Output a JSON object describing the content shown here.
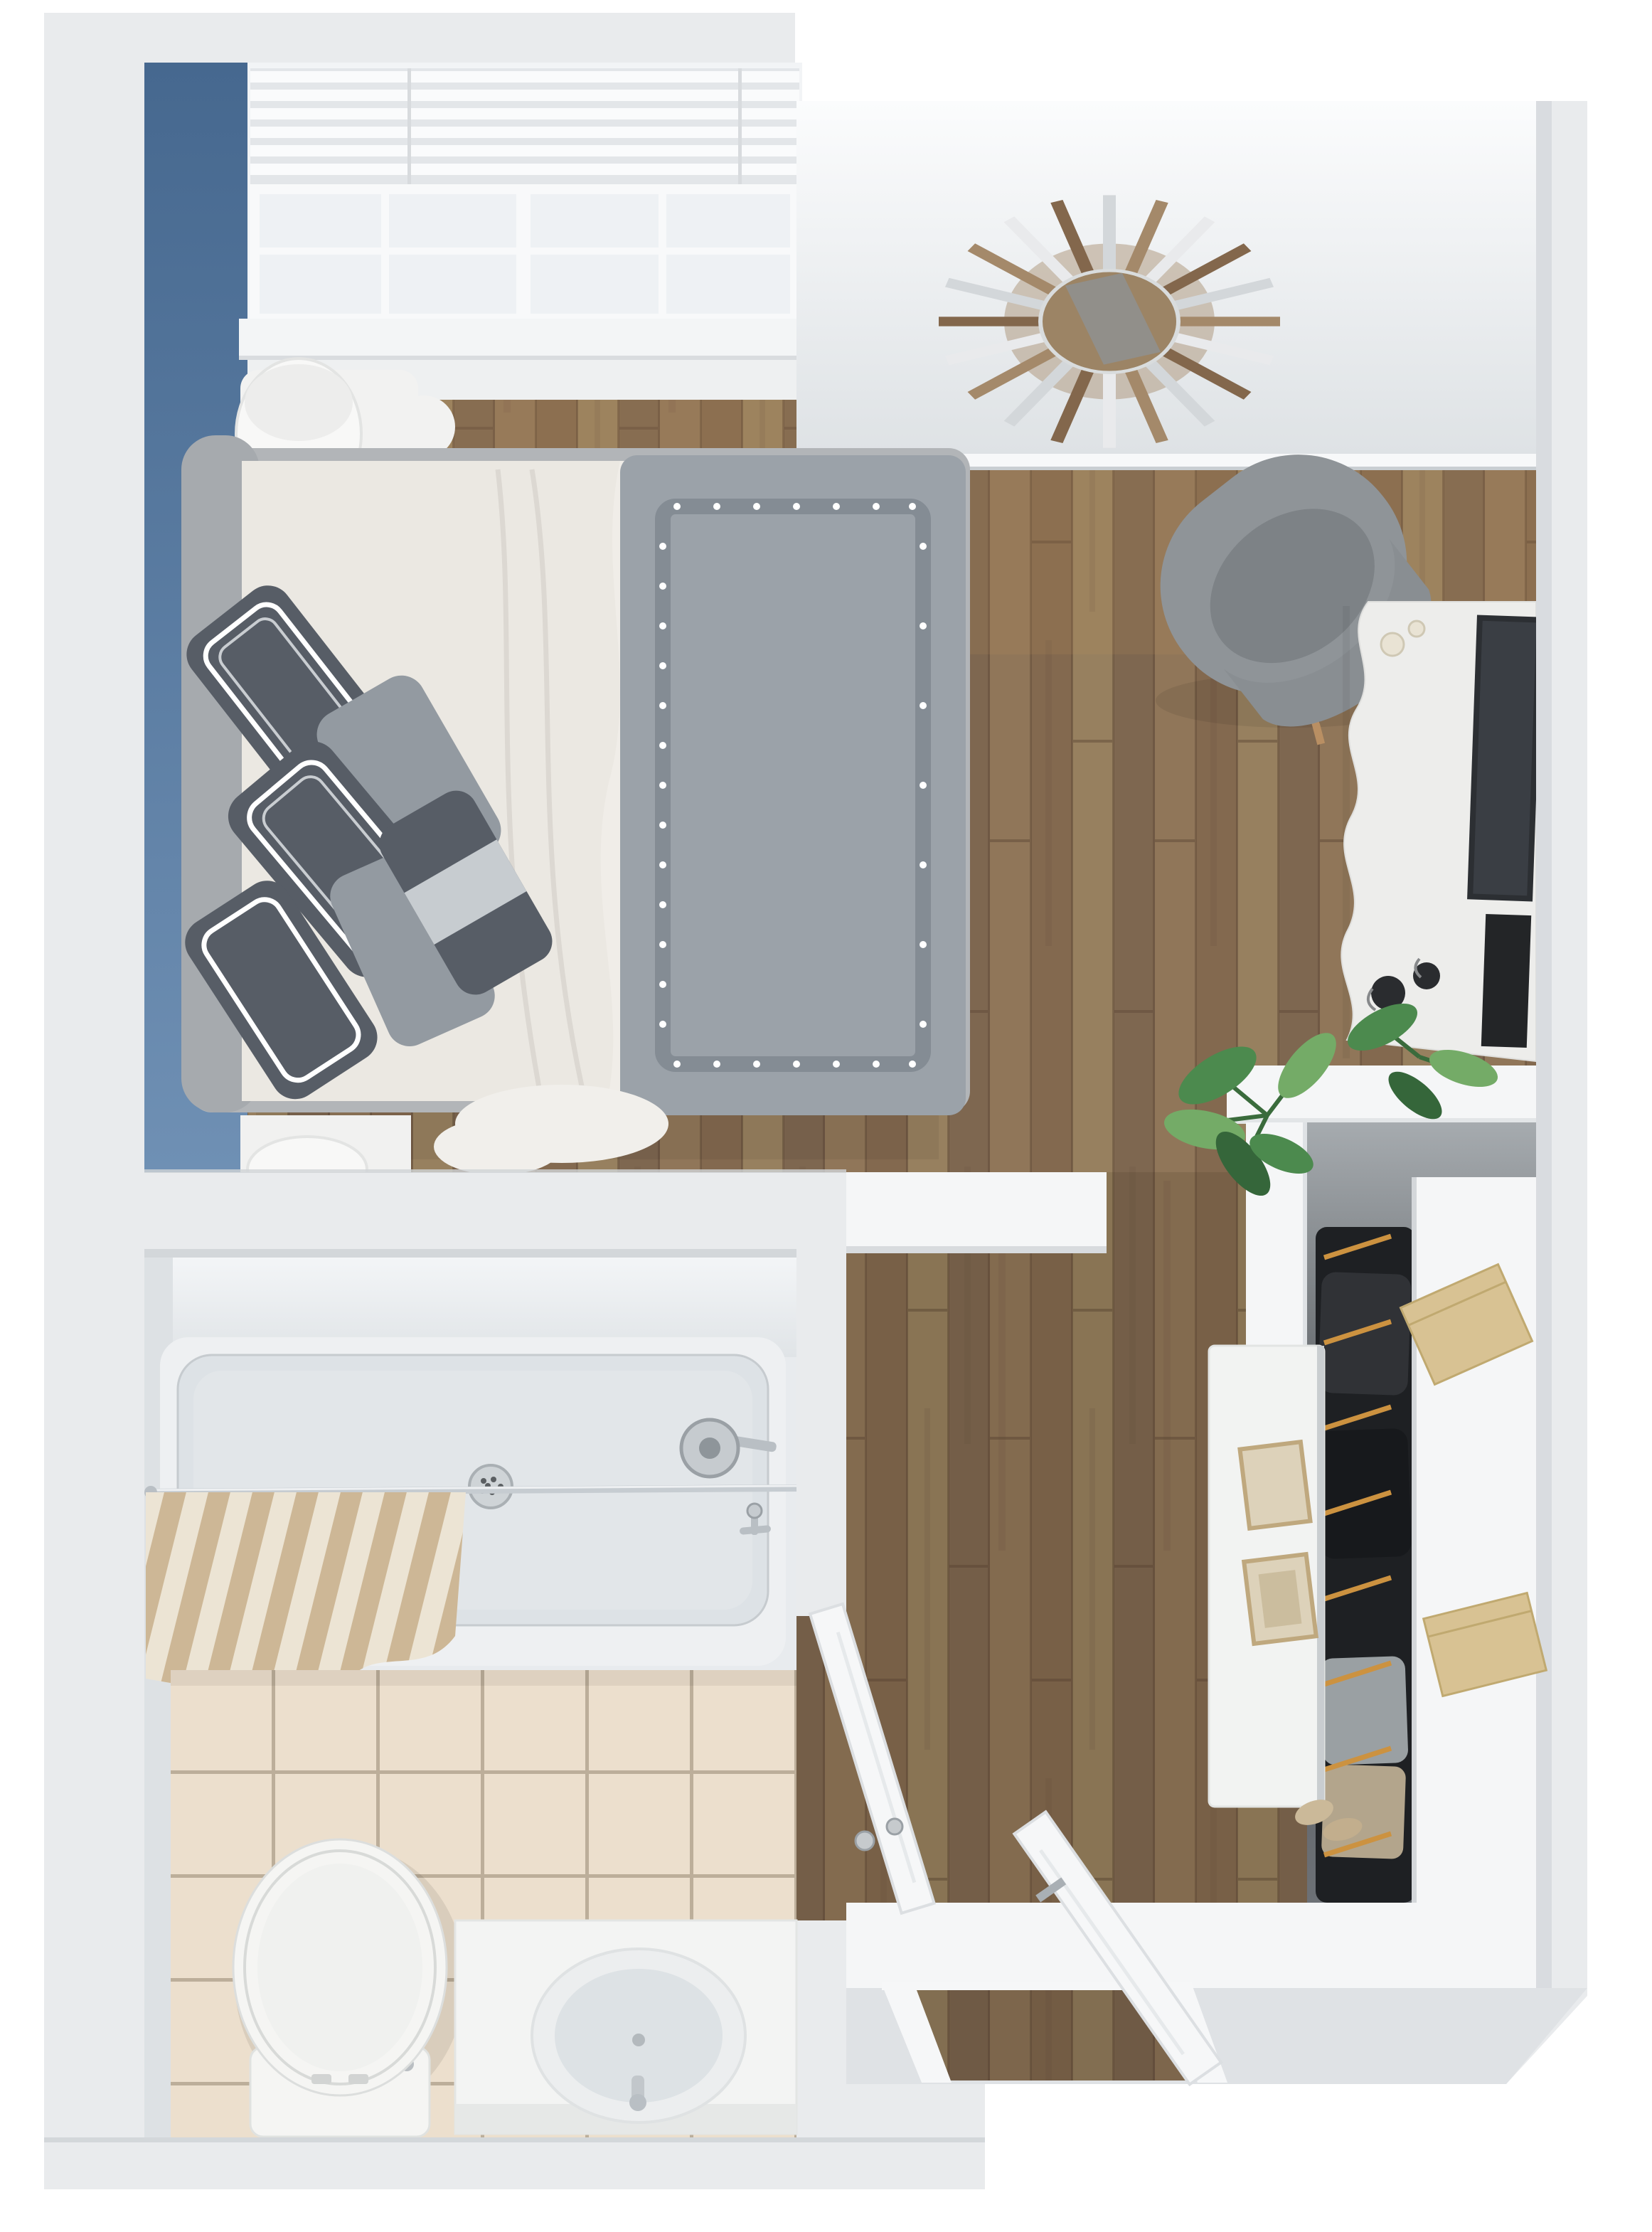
{
  "title": "3D top-down floor plan render of a studio apartment",
  "palette": {
    "bg": "#ffffff",
    "wall_top": "#e9ebed",
    "wall_face": "#dfe2e5",
    "wall_bright": "#f5f6f7",
    "wall_shadow": "#c9ced2",
    "accent_blue": "#54779f",
    "accent_blue_dark": "#46688f",
    "accent_blue_light": "#6f90b4",
    "wood": "#8a7158",
    "wood1": "#907659",
    "wood2": "#83694f",
    "wood3": "#97805f",
    "wood4": "#7e6750",
    "plank_line": "#5f4a37",
    "tile": "#ecdfcd",
    "grout": "#bcae9a",
    "tub_face": "#eef0f2",
    "tub_basin": "#dde2e6",
    "fixture": "#b9bfc4",
    "porcelain": "#f5f5f3",
    "sheet": "#ebe8e2",
    "sheet_fold": "#dcd8d2",
    "duvet": "#9ba2a9",
    "duvet_trim": "#848c94",
    "pillow_dark": "#575d66",
    "pillow_mid": "#939aa1",
    "headboard": "#a6aaae",
    "frame_gray": "#b2b5b8",
    "chair": "#8f9498",
    "chair_seat": "#7d8286",
    "console": "#ededeb",
    "tv": "#2c2f33",
    "plant": "#4c8a4e",
    "plant_light": "#74ab67",
    "plant_dark": "#35663a",
    "hanger": "#cc9240",
    "clothes": "#1e2023",
    "box": "#d8c293",
    "box_edge": "#c0a970",
    "curtain": "#cdb796",
    "curtain_light": "#ece4d4",
    "door": "#f6f7f8",
    "door_edge": "#dcdfe2",
    "knob": "#a9afb4",
    "mirror_silver": "#d3d7da",
    "mirror_wood": "#a4896a",
    "mirror_wood_dark": "#83674c",
    "mirror_center": "#9c8465"
  },
  "scene": {
    "style": "3d-top-down-floor-plan-render",
    "rooms": [
      {
        "id": "bedroom",
        "items": [
          "blue-accent-wall",
          "window-with-blinds",
          "nightstand-with-drum-lamp",
          "upholstered-bench",
          "bed-with-gray-duvet",
          "throw-pillows",
          "foot-nightstand-lamp"
        ]
      },
      {
        "id": "living-area",
        "items": [
          "sunburst-mirror",
          "gray-lounge-chair",
          "white-media-console",
          "flat-screen-tv",
          "candles",
          "decor-bowls",
          "monstera-plant"
        ]
      },
      {
        "id": "closet",
        "items": [
          "hanging-clothes",
          "orange-hangers",
          "storage-boxes",
          "white-shelf",
          "white-dresser",
          "picture-frames",
          "shoes"
        ]
      },
      {
        "id": "bathroom",
        "items": [
          "bathtub-shower",
          "striped-shower-curtain",
          "curtain-rod",
          "shower-head",
          "tub-drain",
          "beige-tile-floor",
          "toilet",
          "vanity-with-oval-sink"
        ]
      },
      {
        "id": "hallway-entry",
        "items": [
          "open-entry-door",
          "open-bathroom-door",
          "entry-door-frame",
          "wood-floor"
        ]
      }
    ]
  }
}
